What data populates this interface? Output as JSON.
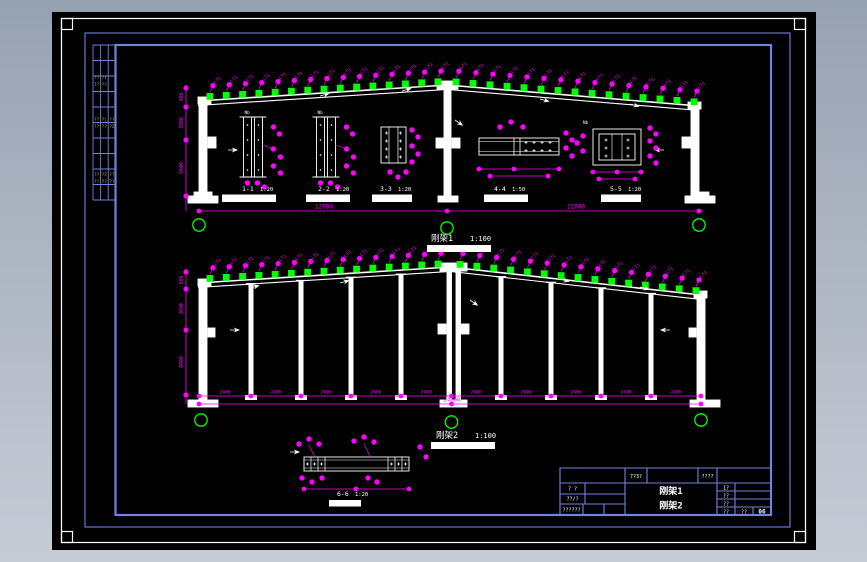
{
  "meta": {
    "black": "#000000",
    "border_blue": "#7082e4",
    "magenta": "#ff00ff",
    "green": "#00ff00",
    "white": "#ffffff",
    "olive": "#a8b838"
  },
  "frame1": {
    "caption": "刚架1",
    "scale": "1:100",
    "span_dims": [
      "12000",
      "12000"
    ],
    "height_dims": [
      "900",
      "3300",
      "5600"
    ],
    "purlin_tag": "LT1"
  },
  "frame2": {
    "caption": "刚架2",
    "scale": "1:100",
    "bay_dims": [
      "2400",
      "2400",
      "2400",
      "2400",
      "2400",
      "2400",
      "2400",
      "2400",
      "2400",
      "2400"
    ],
    "total_dim": "24000",
    "height_dims": [
      "900",
      "3600",
      "8400"
    ],
    "purlin_tag": "LT1"
  },
  "details": [
    {
      "name": "1-1",
      "scale": "1:20"
    },
    {
      "name": "2-2",
      "scale": "1:20"
    },
    {
      "name": "3-3",
      "scale": "1:20"
    },
    {
      "name": "4-4",
      "scale": "1:50"
    },
    {
      "name": "5-5",
      "scale": "1:20"
    },
    {
      "name": "6-6",
      "scale": "1:20"
    }
  ],
  "misc": {
    "weld_label": "Nb"
  },
  "title_block": {
    "top_cells": [
      "7?3?",
      "????"
    ],
    "left_rows": [
      "? ?",
      "??/?",
      "??????"
    ],
    "title_line1": "刚架1",
    "title_line2": "刚架2",
    "right_rows": [
      "1?",
      "??",
      "??"
    ],
    "bottom_cells": [
      "??",
      "??",
      "06"
    ]
  },
  "signature_table": {
    "texts": [
      [
        "??",
        "?7"
      ],
      [
        "7?",
        "??"
      ],
      [
        "??",
        "?|",
        "??"
      ],
      [
        "??",
        "??",
        "?Z"
      ],
      [
        "??",
        "?7",
        "??"
      ],
      [
        "??",
        "7?",
        "??"
      ]
    ]
  }
}
